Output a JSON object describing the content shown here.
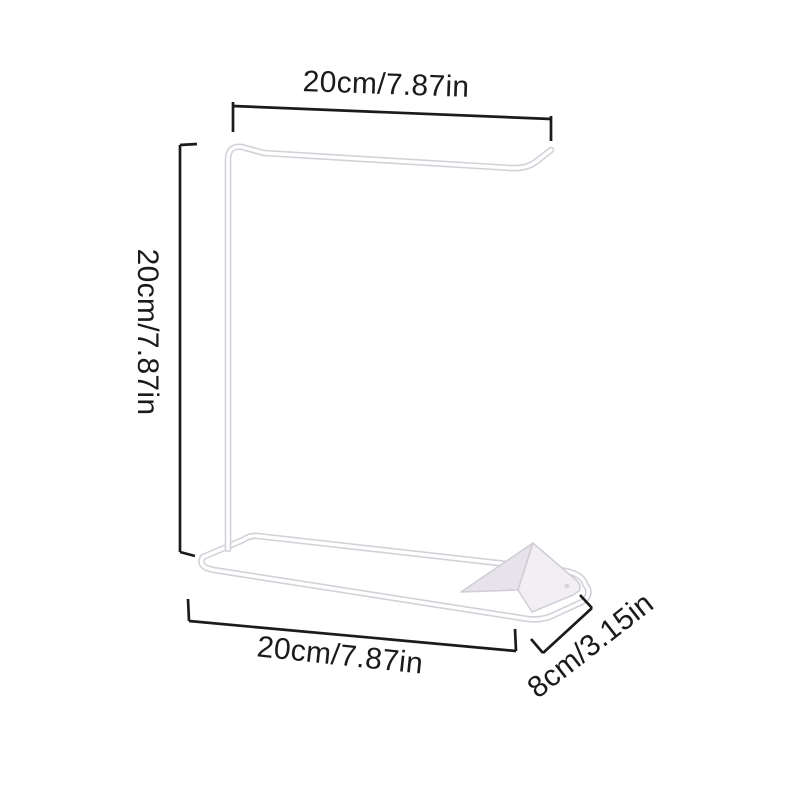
{
  "diagram": {
    "background_color": "#ffffff",
    "dimension_line_color": "#1b1b1b",
    "product": {
      "wire_color": "#ffffff",
      "wire_outline_color": "#d4d0d8",
      "plate_color": "#f1eff4",
      "plate_shaded_color": "#e6e3ea"
    },
    "labels": {
      "top_width": "20cm/7.87in",
      "side_height": "20cm/7.87in",
      "base_width": "20cm/7.87in",
      "base_depth": "8cm/3.15in"
    }
  }
}
